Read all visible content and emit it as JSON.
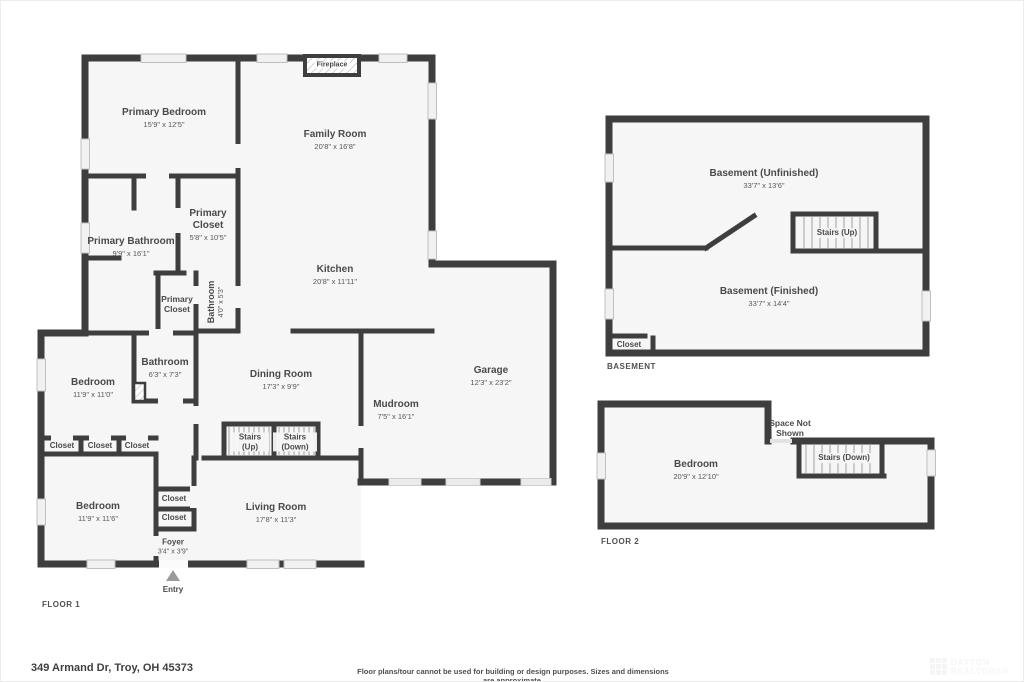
{
  "address": "349 Armand Dr, Troy, OH 45373",
  "disclaimer": "Floor plans/tour cannot be used for building or design purposes. Sizes and dimensions are approximate.",
  "watermark": {
    "line1": "DAYTON",
    "line2": "REALTORS®"
  },
  "colors": {
    "wall": "#3e3e3e",
    "room_fill": "#f6f6f6",
    "label_text": "#4a4a4a",
    "window_fill": "#f1f1f1"
  },
  "floor1": {
    "label": "FLOOR 1",
    "entry_label": "Entry",
    "fireplace_label": "Fireplace",
    "rooms": [
      {
        "name": "Primary Bedroom",
        "dims": "15'9\" x 12'5\""
      },
      {
        "name": "Family Room",
        "dims": "20'8\" x 16'8\""
      },
      {
        "name": "Primary Bathroom",
        "dims": "9'9\" x 16'1\""
      },
      {
        "name": "Primary Closet",
        "dims": "5'8\" x 10'5\""
      },
      {
        "name": "Kitchen",
        "dims": "20'8\" x 11'11\""
      },
      {
        "name": "Primary Closet"
      },
      {
        "name": "Bathroom",
        "dims": "4'0\" x 5'3\""
      },
      {
        "name": "Bathroom",
        "dims": "6'3\" x 7'3\""
      },
      {
        "name": "Bedroom",
        "dims": "11'9\" x 11'0\""
      },
      {
        "name": "Dining Room",
        "dims": "17'3\" x 9'9\""
      },
      {
        "name": "Mudroom",
        "dims": "7'5\" x 16'1\""
      },
      {
        "name": "Garage",
        "dims": "12'3\" x 23'2\""
      },
      {
        "name": "Closet"
      },
      {
        "name": "Closet"
      },
      {
        "name": "Closet"
      },
      {
        "name": "Stairs (Up)"
      },
      {
        "name": "Stairs (Down)"
      },
      {
        "name": "Closet"
      },
      {
        "name": "Closet"
      },
      {
        "name": "Bedroom",
        "dims": "11'9\" x 11'6\""
      },
      {
        "name": "Living Room",
        "dims": "17'8\" x 11'3\""
      },
      {
        "name": "Foyer",
        "dims": "3'4\" x 3'9\""
      }
    ]
  },
  "basement": {
    "label": "BASEMENT",
    "rooms": [
      {
        "name": "Basement (Unfinished)",
        "dims": "33'7\" x 13'6\""
      },
      {
        "name": "Stairs (Up)"
      },
      {
        "name": "Basement (Finished)",
        "dims": "33'7\" x 14'4\""
      },
      {
        "name": "Closet"
      }
    ]
  },
  "floor2": {
    "label": "FLOOR 2",
    "rooms": [
      {
        "name": "Space Not Shown"
      },
      {
        "name": "Bedroom",
        "dims": "20'9\" x 12'10\""
      },
      {
        "name": "Stairs (Down)"
      }
    ]
  }
}
